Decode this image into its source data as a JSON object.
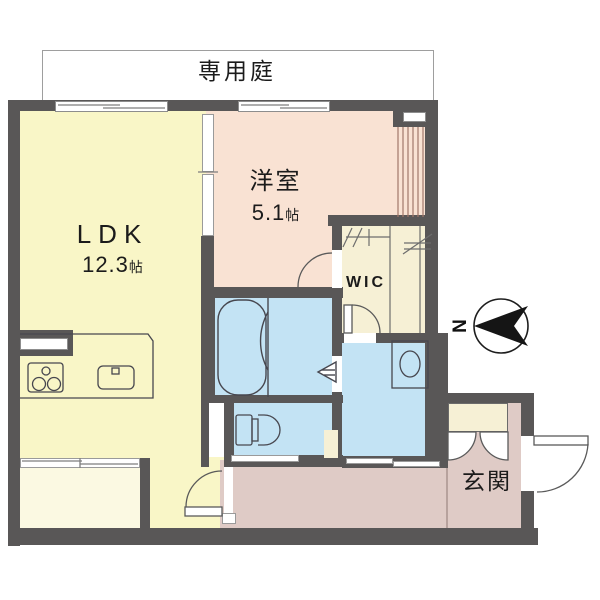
{
  "garden": {
    "label": "専用庭"
  },
  "rooms": {
    "ldk": {
      "name": "LDK",
      "size_value": "12.3",
      "size_unit": "帖"
    },
    "western_room": {
      "name": "洋室",
      "size_value": "5.1",
      "size_unit": "帖"
    },
    "wic": {
      "label": "WIC"
    },
    "entrance": {
      "label": "玄関"
    }
  },
  "compass": {
    "north_label": "N",
    "arrow_points": "left"
  },
  "colors": {
    "wall": "#595757",
    "ldk_floor": "#F9F6C7",
    "western_room_floor": "#F9E2D3",
    "closet_floor": "#F6F0D5",
    "wet_area_floor": "#C3E3F4",
    "hall_floor": "#DFCBC6",
    "garden": "#FFFFFF",
    "fixture_line": "#47474f"
  },
  "fixtures": [
    "bathtub",
    "toilet",
    "washbasin",
    "kitchen-sink",
    "gas-stove",
    "shoe-cabinet",
    "hanger-pipe",
    "shelf",
    "entrance-door",
    "sliding-doors",
    "range-hood-counter"
  ]
}
